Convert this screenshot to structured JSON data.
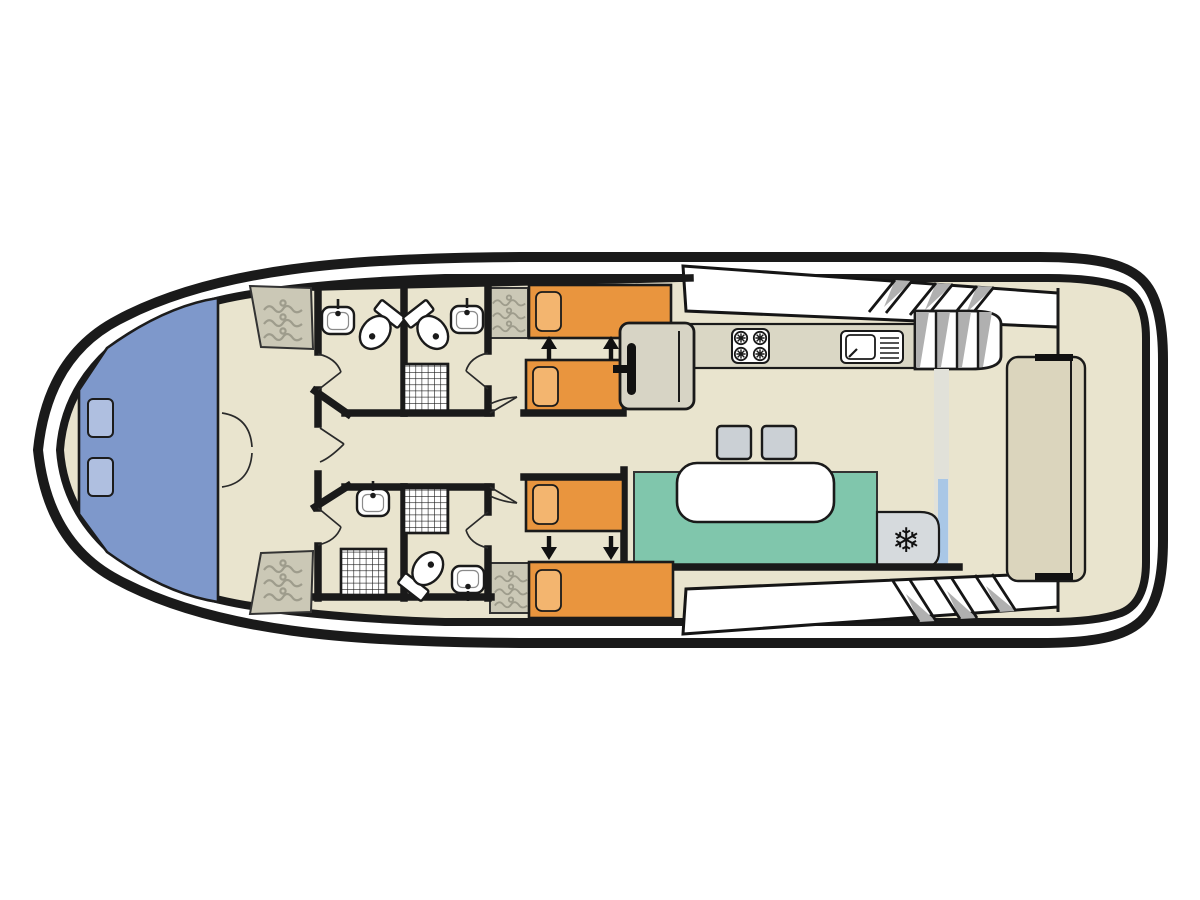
{
  "figure": {
    "type": "houseboat-deck-plan",
    "orientation": "bow-left",
    "rooms": [
      "bow-deck",
      "fore-cabin",
      "bathroom-port-fore",
      "bathroom-port-mid",
      "bathroom-starboard-fore",
      "bathroom-starboard-mid",
      "cabin-port",
      "cabin-starboard",
      "galley",
      "dinette-salon",
      "aft-deck"
    ],
    "fixtures": [
      "wardrobes",
      "twin-sliding-beds",
      "toilets",
      "sinks",
      "shower-grates",
      "stove",
      "galley-sink",
      "staircase",
      "fridge",
      "dinette-table",
      "stools",
      "helm-console",
      "aft-bench",
      "deck-hatches",
      "side-deck-steps"
    ]
  },
  "palette": {
    "hull": "#1a1a1a",
    "paper": "#ffffff",
    "interior": "#e9e4ce",
    "bow_deck": "#7e98cb",
    "hatch": "#afbfe0",
    "bed": "#e9953e",
    "pillow": "#f3b56f",
    "seating": "#80c6ac",
    "counter": "#dad7c5",
    "furniture": "#d7d4c5",
    "wardrobe": "#cbc8b6",
    "hanger": "#9e9c8c",
    "cool_gray": "#cbd0d5",
    "fridge": "#d6dadd",
    "bench_aft": "#dbd5bd",
    "strip": "#e1e1d9",
    "window_blue": "#a9c7e6",
    "shade": "#b0b0b0",
    "table": "#ffffff",
    "wall": "#1a1a1a"
  },
  "icons": {
    "snowflake": "❄"
  }
}
